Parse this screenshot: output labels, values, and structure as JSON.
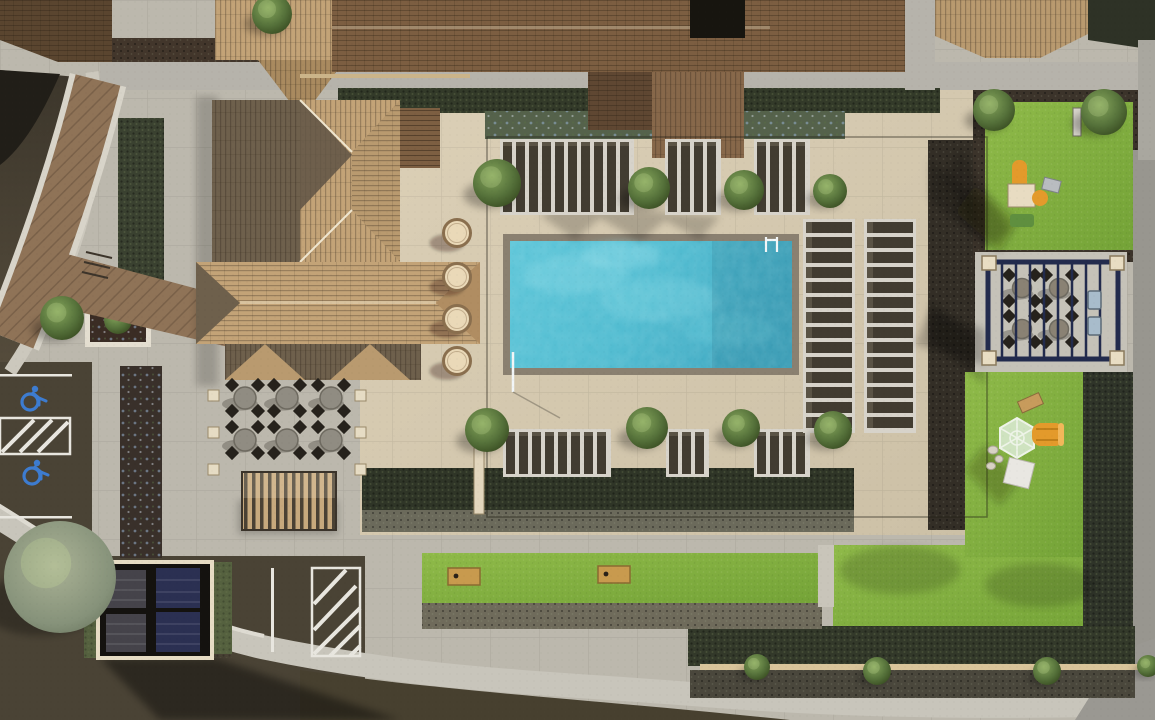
{
  "scene": {
    "kind": "aerial-3d-rendering",
    "subject": "apartment community amenity courtyard viewed from directly above",
    "regions": {
      "top": "apartment building shingle roofs with mulch planting beds and a gray concrete sidewalk",
      "left": "curved asphalt drive with brown paver entry walk, planters and accessible parking stalls",
      "center_west": "clubhouse with tan tile hip roof, outdoor dining patio with six tables and striped awning",
      "center": "rectangular swimming pool with tan paver sun deck, chaise lounges, four round daybeds and trees",
      "east": "tot-lot lawn with orange play structure, navy picnic pergola with grills, playground lawn with climbing dome and orange slide",
      "south": "lawn panels with cornhole boards, hedge and shrub borders, curved sidewalk and asphalt drive",
      "southwest": "parking stalls with solar-panel carport and white-striped hatched aisles"
    },
    "palette": {
      "pool_water": "#54bfd4",
      "pool_water_light": "#8bd9e4",
      "pool_coping": "#8a8070",
      "deck_paver": "#d6cab1",
      "concrete": "#bcb8ad",
      "lawn": "#85b23f",
      "hedge": "#333a29",
      "mulch": "#39302a",
      "asphalt": "#4a4335",
      "asphalt_dark": "#211e18",
      "roof_tan": "#c3a377",
      "roof_brown": "#7c5e41",
      "roof_dark": "#605548",
      "paver_path_brown": "#8f7357",
      "pergola_navy": "#222b4d",
      "play_orange": "#e39a2b",
      "accessible_blue": "#3d7cd0",
      "lounger": "#423c31",
      "daybed": "#ead9b8",
      "stripe_white": "#e8e6df"
    },
    "counts": {
      "round_daybeds": 4,
      "patio_dining_tables": 6,
      "pergola_picnic_tables": 4,
      "grills": 2,
      "accessible_parking_stalls": 2,
      "cornhole_boards": 2,
      "play_structures": 2,
      "solar_carport_panels": 4
    },
    "furniture": {
      "lounger_groups_top": [
        {
          "x": 503,
          "y": 142,
          "count": 10
        },
        {
          "x": 668,
          "y": 142,
          "count": 4
        },
        {
          "x": 757,
          "y": 142,
          "count": 4
        }
      ],
      "lounger_groups_bottom": [
        {
          "x": 506,
          "y": 432,
          "count": 8
        },
        {
          "x": 669,
          "y": 432,
          "count": 3
        },
        {
          "x": 757,
          "y": 432,
          "count": 4
        }
      ],
      "lounger_columns_right": [
        {
          "x": 806,
          "y": 222,
          "count": 14
        },
        {
          "x": 867,
          "y": 222,
          "count": 14
        }
      ],
      "patio_tables": [
        [
          245,
          398
        ],
        [
          287,
          398
        ],
        [
          331,
          398
        ],
        [
          245,
          440
        ],
        [
          287,
          440
        ],
        [
          331,
          440
        ]
      ],
      "pergola_tables": [
        [
          1022,
          288
        ],
        [
          1059,
          288
        ],
        [
          1022,
          329
        ],
        [
          1059,
          329
        ]
      ],
      "daybeds": {
        "x": 457,
        "ys": [
          233,
          277,
          319,
          361
        ],
        "r": 13.5
      },
      "cornhole_boards": [
        [
          448,
          568
        ],
        [
          598,
          566
        ]
      ],
      "wheelchair_marks": [
        [
          30,
          398
        ],
        [
          32,
          472
        ]
      ]
    },
    "trees": {
      "green": [
        [
          497,
          183,
          24
        ],
        [
          649,
          188,
          21
        ],
        [
          744,
          190,
          20
        ],
        [
          830,
          191,
          17
        ],
        [
          487,
          430,
          22
        ],
        [
          647,
          428,
          21
        ],
        [
          741,
          428,
          19
        ],
        [
          833,
          430,
          19
        ],
        [
          994,
          110,
          21
        ],
        [
          1104,
          112,
          23
        ],
        [
          272,
          14,
          20
        ],
        [
          62,
          318,
          22
        ],
        [
          757,
          667,
          13
        ],
        [
          877,
          671,
          14
        ],
        [
          1047,
          671,
          14
        ],
        [
          1148,
          666,
          11
        ]
      ],
      "olive": [
        [
          60,
          577,
          56
        ]
      ]
    }
  }
}
